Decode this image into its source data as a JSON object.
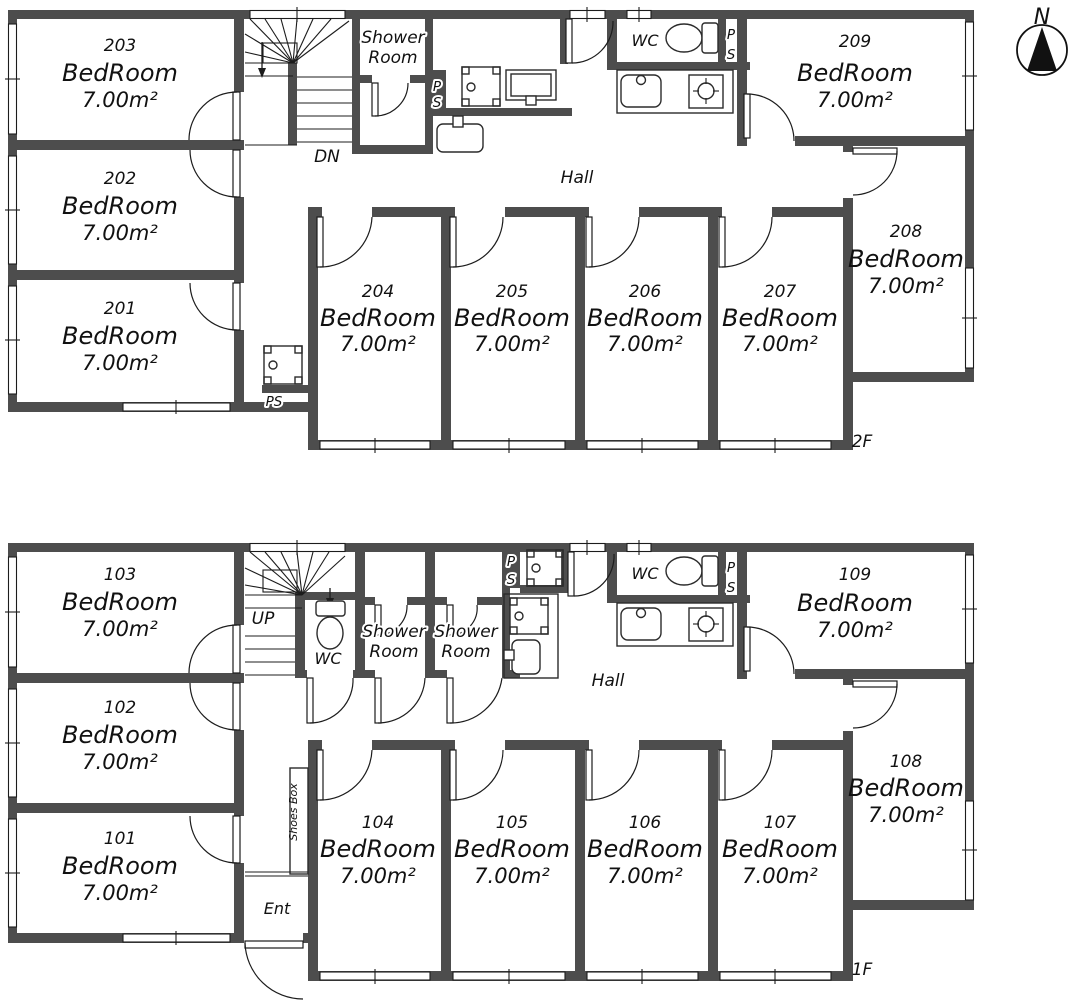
{
  "colors": {
    "wall": "#4d4d4d",
    "line": "#1c1c1c",
    "background": "#ffffff"
  },
  "compass": {
    "label": "N"
  },
  "floor_2f": {
    "floor_label": "2F",
    "hall_label": "Hall",
    "stair_label": "DN",
    "wc_label": "WC",
    "shower_room": {
      "line1": "Shower",
      "line2": "Room"
    },
    "ps_kitchen": {
      "line1": "P",
      "line2": "S"
    },
    "ps_laundry": {
      "line1": "P",
      "line2": "S"
    },
    "ps_shaft_label": "PS",
    "rooms": {
      "r201": {
        "number": "201",
        "name": "BedRoom",
        "area": "7.00m²"
      },
      "r202": {
        "number": "202",
        "name": "BedRoom",
        "area": "7.00m²"
      },
      "r203": {
        "number": "203",
        "name": "BedRoom",
        "area": "7.00m²"
      },
      "r204": {
        "number": "204",
        "name": "BedRoom",
        "area": "7.00m²"
      },
      "r205": {
        "number": "205",
        "name": "BedRoom",
        "area": "7.00m²"
      },
      "r206": {
        "number": "206",
        "name": "BedRoom",
        "area": "7.00m²"
      },
      "r207": {
        "number": "207",
        "name": "BedRoom",
        "area": "7.00m²"
      },
      "r208": {
        "number": "208",
        "name": "BedRoom",
        "area": "7.00m²"
      },
      "r209": {
        "number": "209",
        "name": "BedRoom",
        "area": "7.00m²"
      }
    }
  },
  "floor_1f": {
    "floor_label": "1F",
    "hall_label": "Hall",
    "stair_label": "UP",
    "wc_stairs_label": "WC",
    "wc_kitchen_label": "WC",
    "shower_room_1": {
      "line1": "Shower",
      "line2": "Room"
    },
    "shower_room_2": {
      "line1": "Shower",
      "line2": "Room"
    },
    "ps_kitchen": {
      "line1": "P",
      "line2": "S"
    },
    "ps_laundry": {
      "line1": "P",
      "line2": "S"
    },
    "shoes_box_label": "Shoes Box",
    "entrance_label": "Ent",
    "rooms": {
      "r101": {
        "number": "101",
        "name": "BedRoom",
        "area": "7.00m²"
      },
      "r102": {
        "number": "102",
        "name": "BedRoom",
        "area": "7.00m²"
      },
      "r103": {
        "number": "103",
        "name": "BedRoom",
        "area": "7.00m²"
      },
      "r104": {
        "number": "104",
        "name": "BedRoom",
        "area": "7.00m²"
      },
      "r105": {
        "number": "105",
        "name": "BedRoom",
        "area": "7.00m²"
      },
      "r106": {
        "number": "106",
        "name": "BedRoom",
        "area": "7.00m²"
      },
      "r107": {
        "number": "107",
        "name": "BedRoom",
        "area": "7.00m²"
      },
      "r108": {
        "number": "108",
        "name": "BedRoom",
        "area": "7.00m²"
      },
      "r109": {
        "number": "109",
        "name": "BedRoom",
        "area": "7.00m²"
      }
    }
  }
}
